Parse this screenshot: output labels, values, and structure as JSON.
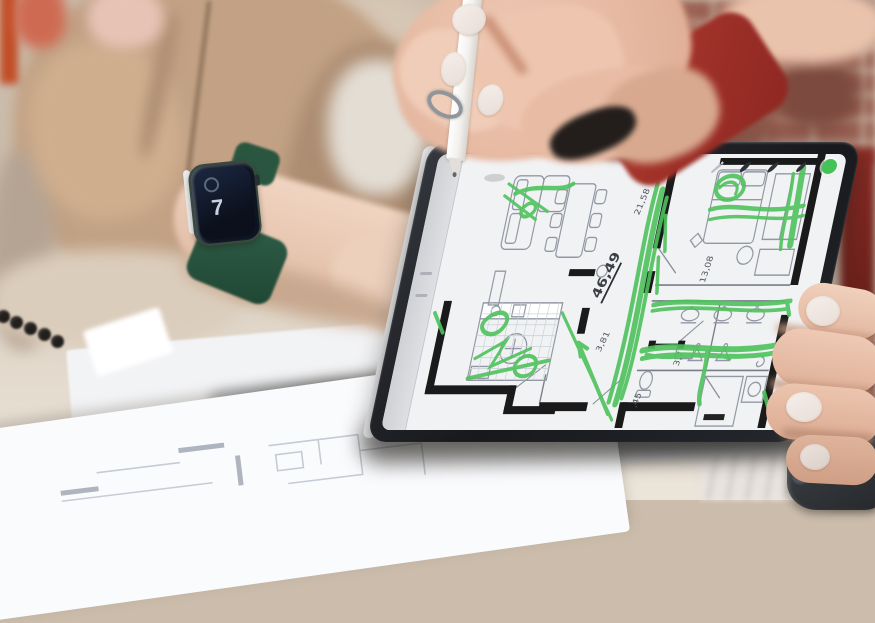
{
  "tablet_app": {
    "toolbar": {
      "icons": [
        {
          "name": "pencil-tool-icon",
          "color": "#b9bdc4"
        },
        {
          "name": "pen-tool-icon",
          "color": "#2e3238"
        },
        {
          "name": "marker-tool-icon",
          "color": "#2e3238"
        },
        {
          "name": "ink-pen-tool-icon",
          "color": "#2e3238"
        },
        {
          "name": "active-color-swatch",
          "color": "#45c257"
        }
      ]
    },
    "floor_plan": {
      "labels": {
        "area_total": "46,49",
        "dim_top": "21,58",
        "dim_left": "3,81",
        "dim_right": "13,08",
        "dim_lower": "3,7",
        "dim_bottom": ",45"
      },
      "ink_color": "#4fc25c",
      "wall_color": "#1a1a1a",
      "furniture_color": "#9298a3"
    }
  },
  "smartwatch": {
    "display_digit": "7",
    "band_color": "#2c5a44"
  },
  "palette": {
    "blazer_tan": "#c2a184",
    "sleeve_red": "#9d2f28",
    "brick_wall": "#9a6153",
    "table_surface": "#e9e2d6",
    "tablet_bezel": "#1b1e22",
    "screen_white": "#f1f2f4"
  }
}
